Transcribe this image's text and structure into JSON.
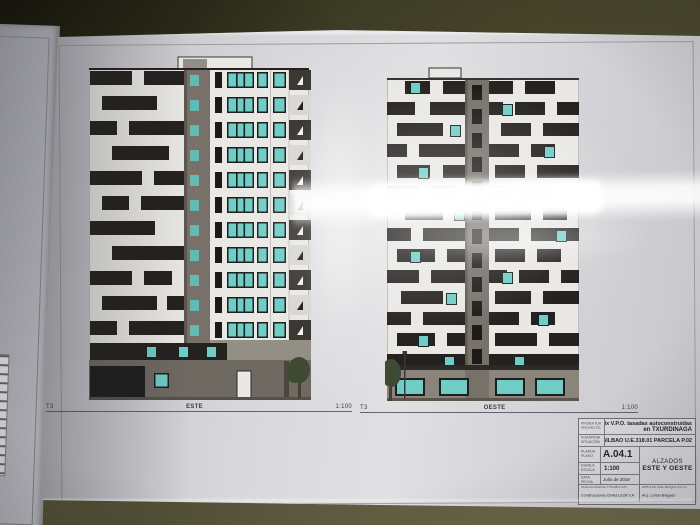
{
  "scene_description": "Photograph of a printed architectural elevation sheet lying on a dark olive table, with a second sheet partially visible at left and strong light glare across the page",
  "colors": {
    "table_olive": "#4b4831",
    "sheet_white": "#d9d9dc",
    "under_sheet": "#9d9da4",
    "facade_white": "#e9e8e5",
    "facade_dark": "#24211f",
    "core_gray": "#77716a",
    "ground_gray": "#6e6961",
    "window_teal": "#6fcdc6",
    "window_dark": "#1b1a19",
    "tree_green": "#3e4a31",
    "title_text": "#26262a",
    "glare": "#ffffff"
  },
  "sheet": {
    "drawings": {
      "este": {
        "marker": "T3",
        "name": "ESTE",
        "scale": "1:100"
      },
      "oeste": {
        "marker": "T3",
        "name": "OESTE",
        "scale": "1:100"
      }
    },
    "title_block": {
      "project_label_eu": "PROIEKTUA",
      "project_label_es": "PROYECTO",
      "project_value_line1": "4x V.P.O. tasadas autoconstruidas",
      "project_value_line2": "en TXURDINAGA",
      "location_label_eu": "KOKAPENA",
      "location_label_es": "SITUACIÓN",
      "location_value": "BILBAO U.E.318.01 PARCELA P.02",
      "plan_label_eu": "PLANOA",
      "plan_label_es": "PLANO",
      "plan_number": "A.04.1",
      "scale_label_eu": "ESKALA",
      "scale_label_es": "ESCALA",
      "scale_value": "1:100",
      "date_label_eu": "DATA",
      "date_label_es": "FECHA",
      "date_value": "Julio de 2018",
      "sheet_title_line1": "ALZADOS",
      "sheet_title_line2": "ESTE Y OESTE",
      "developer_label_eu": "SUSTATZAILEA",
      "developer_label_es": "PROMOTOR",
      "developer_value": "Construcciones Civiles LEZA S.A",
      "architect_label_eu": "ARKITEKTOA",
      "architect_label_es": "ARQUITECTO",
      "architect_value": "Arq.: Loreto Bragado"
    }
  }
}
